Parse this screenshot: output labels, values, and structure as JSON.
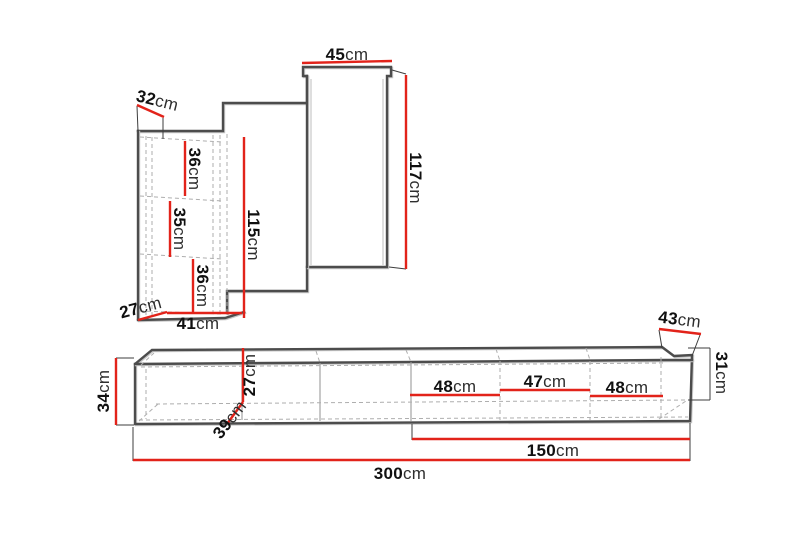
{
  "figure": {
    "type": "furniture-dimension-diagram",
    "background": "#ffffff",
    "accent_red": "#e2231a",
    "outline_gray": "#4c4c4c",
    "wall_unit": {
      "dimensions": {
        "top_width": {
          "value": "45",
          "unit": "cm"
        },
        "left_depth_top": {
          "value": "32",
          "unit": "cm"
        },
        "right_height": {
          "value": "117",
          "unit": "cm"
        },
        "middle_height": {
          "value": "115",
          "unit": "cm"
        },
        "shelf_top": {
          "value": "36",
          "unit": "cm"
        },
        "shelf_middle": {
          "value": "35",
          "unit": "cm"
        },
        "shelf_bottom": {
          "value": "36",
          "unit": "cm"
        },
        "left_depth_bottom": {
          "value": "27",
          "unit": "cm"
        },
        "bottom_width": {
          "value": "41",
          "unit": "cm"
        }
      }
    },
    "tv_bench": {
      "dimensions": {
        "left_height": {
          "value": "34",
          "unit": "cm"
        },
        "inner_height": {
          "value": "27",
          "unit": "cm"
        },
        "depth_diagonal": {
          "value": "39",
          "unit": "cm"
        },
        "compartment_left": {
          "value": "48",
          "unit": "cm"
        },
        "compartment_middle": {
          "value": "47",
          "unit": "cm"
        },
        "compartment_right": {
          "value": "48",
          "unit": "cm"
        },
        "right_depth": {
          "value": "43",
          "unit": "cm"
        },
        "right_height": {
          "value": "31",
          "unit": "cm"
        },
        "half_width": {
          "value": "150",
          "unit": "cm"
        },
        "total_width": {
          "value": "300",
          "unit": "cm"
        }
      }
    }
  }
}
